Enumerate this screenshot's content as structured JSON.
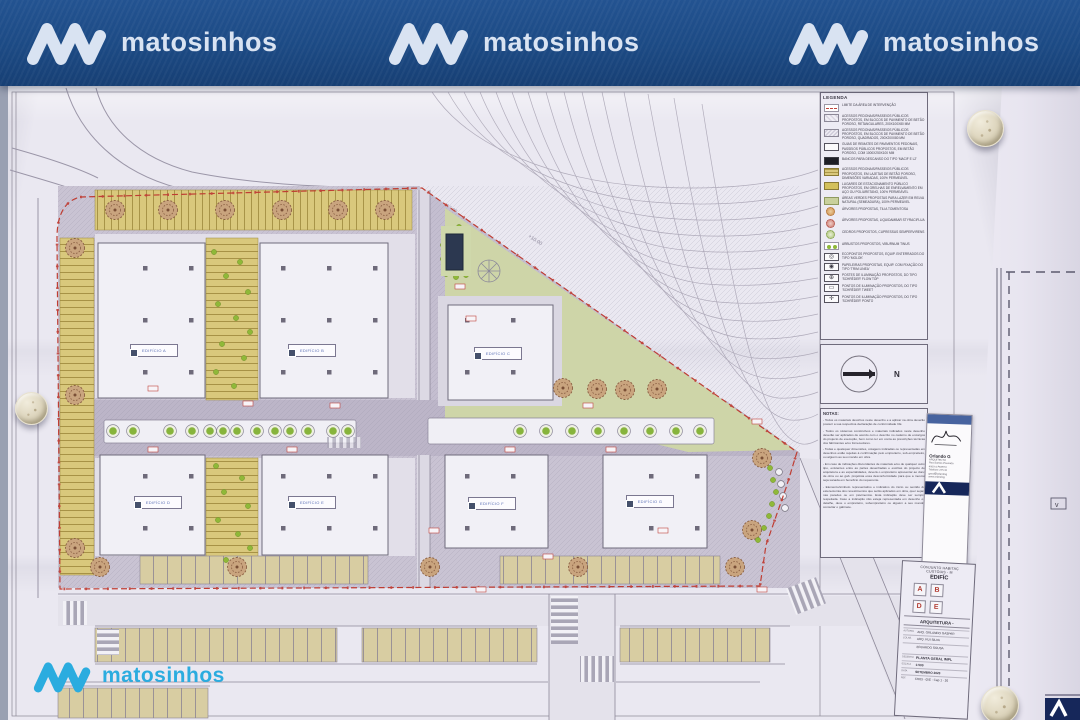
{
  "colors": {
    "banner_blue": "#1d4b86",
    "logo_white": "#d9e3f2",
    "logo_cyan": "#2bacdf",
    "boundary_red": "#bf3d33",
    "parking_yellow": "#d9c87c",
    "lawn_green": "#ced5a8",
    "paving_gray": "#c5bfcf",
    "title_letter_red": "#b23a30"
  },
  "banner": {
    "logo_text": "matosinhos"
  },
  "footer_logo_text": "matosinhos",
  "sheet": {
    "legend": {
      "title": "LEGENDA",
      "items": [
        {
          "icon": "boundary-line",
          "label": "Limite da área de intervenção"
        },
        {
          "icon": "paving-blocks-rect",
          "label": "Acessos pedonais/passeios públicos propostos, em blocos de pavimento de betão poroso, retangulares, 200x100x80 mm"
        },
        {
          "icon": "paving-blocks-square",
          "label": "Acessos pedonais/passeios públicos propostos, em blocos de pavimento de betão poroso, quadrados, 200x200x80 mm"
        },
        {
          "icon": "kerb",
          "label": "Guias de remates de pavimentos pedonais, passeios públicos propostos, em betão poroso, com 1000x250x100 mm"
        },
        {
          "icon": "bench",
          "label": "Bancos para descanso do tipo 'MACIF E L2'"
        },
        {
          "icon": "slabs-yellow",
          "label": "Acessos pedonais/passeios públicos propostos, em lajetas de betão poroso, dimensões variadas, 100% permeável"
        },
        {
          "icon": "parking-yellow",
          "label": "Lugares de estacionamento público propostos, em grelhas de enrelvamento em aço ou poliuretano, 100% permeável"
        },
        {
          "icon": "lawn-green",
          "label": "Áreas verdes propostas para lazer em relva natural (semeadura), 100% permeável"
        },
        {
          "icon": "tree-orange",
          "label": "Árvores propostas, Tilia tomentosa"
        },
        {
          "icon": "tree-red",
          "label": "Árvores propostas, Liquidambar styraciflua"
        },
        {
          "icon": "tree-green",
          "label": "Cedros propostos, Cupressus sempervirens"
        },
        {
          "icon": "shrubs",
          "label": "Arbustos propostos, Viburnum tinus"
        },
        {
          "icon": "ecopoint",
          "label": "Ecopontos propostos, equip. enterrados do tipo 'MOLOK'"
        },
        {
          "icon": "litter-bin",
          "label": "Papeleiras propostas, equip. com fixação do tipo 'TRIM LINEA'"
        },
        {
          "icon": "light-pole",
          "label": "Postes de iluminação propostos, do tipo 'Schréder' FLOW TOP"
        },
        {
          "icon": "light-bollard",
          "label": "Pontos de iluminação propostos, do tipo 'Schréder' TWEET"
        },
        {
          "icon": "light-point",
          "label": "Pontos de iluminação propostos, do tipo 'Schréder' PONTO"
        }
      ]
    },
    "north": {
      "label": "N"
    },
    "notes": {
      "title": "NOTAS:",
      "paragraphs": [
        "- Todos os materiais descritos neste desenho e a aplicar na obra deverão possuir a sua respectiva declaração de conformidade CE.",
        "- Todos os sistemas construtivos e materiais indicados neste desenho deverão ser aplicados de acordo com o descrito no caderno de encargos do projecto de execução, bem como ter em conta as prescrições técnicas dos fabricantes e/ou fornecedores.",
        "- Todas e quaisquer dimensões, cotagens indicadas ou representadas em desenhos estão sujeitas à confirmação pelo empreiteiro, sub-empreiteiro, ou alguém ao seu mando em obra.",
        "- Em caso de indicações discordantes de materiais e/ou de qualquer outro tipo, existentes entre as partes desenhadas e escritas do projecto de arquitetura e as especialidades, deverá o empreiteiro apresentar ao dono de obra ou ao gab. projetista essa desconformidade para que a mesma seja sanada em benefício do requerente.",
        "- Elemento/símbolo representativo e indicativo do início ou sentido da estereotomia dos revestimentos que serão aplicados em obra, quer sejam nas paredes ou em pavimentos. Esta indicação deve ser sempre respeitada. Caso a indicação não esteja representada em desenho ou detalhe, deve o empreiteiro, subempreiteiro ou alguém a seu mando, consultar o gabinete."
      ]
    },
    "stamp": {
      "name": "Orlando G",
      "lines": [
        "ARQUITECTO",
        "Rua Santos Pousada",
        "4000-4 PORTO",
        "Telefone 225 10",
        "geral@orlandog",
        "www.orlandog"
      ]
    },
    "title_block": {
      "project_line1": "CONJUNTO HABITAÇ",
      "project_line2": "CUSTÓIAS - M",
      "project_line3": "EDIFÍC",
      "block_letters": [
        "A",
        "B",
        "D",
        "E"
      ],
      "section": "ARQUITETURA -",
      "team": [
        "ARQ. ORLANDO GASPAR",
        "ARQ. RUI SILVA",
        "EDUARDO SOUSA"
      ],
      "team_labels": [
        "AUTORIA",
        "COLAB.",
        ""
      ],
      "rows": [
        {
          "label": "DESENHO",
          "value": "PLANTA GERAL IMPL"
        },
        {
          "label": "ESCALA",
          "value": "1:500"
        },
        {
          "label": "DATA",
          "value": "SETEMBRO 2023"
        },
        {
          "label": "REF.",
          "value": "CH03 - 05E - Cap 1 - 20"
        }
      ]
    },
    "plan": {
      "buildings": [
        {
          "id": "A",
          "label": "EDIFÍCIO A"
        },
        {
          "id": "B",
          "label": "EDIFÍCIO B"
        },
        {
          "id": "C",
          "label": "EDIFÍCIO C"
        },
        {
          "id": "D",
          "label": "EDIFÍCIO D"
        },
        {
          "id": "E",
          "label": "EDIFÍCIO E"
        },
        {
          "id": "F",
          "label": "EDIFÍCIO F"
        },
        {
          "id": "G",
          "label": "EDIFÍCIO G"
        }
      ],
      "contour_labels": [
        "+12.00",
        "+10.00"
      ]
    },
    "right_sheet": {
      "v_mark": "v"
    }
  }
}
